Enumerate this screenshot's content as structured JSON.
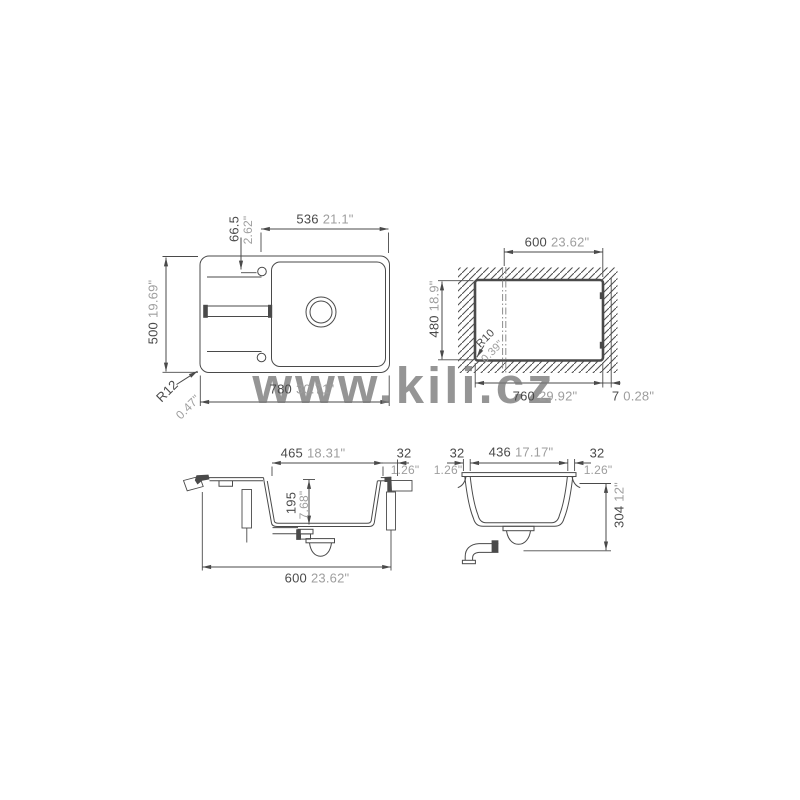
{
  "watermark": "www.kili.cz",
  "colors": {
    "line": "#4a4a4a",
    "metric_text": "#4a4a4a",
    "inch_text": "#9e9e9e",
    "watermark": "#787878"
  },
  "views": {
    "top": {
      "faucet_offset": {
        "mm": "536",
        "in": "21.1\""
      },
      "faucet_inset": {
        "mm": "66.5",
        "in": "2.62\""
      },
      "depth": {
        "mm": "500",
        "in": "19.69\""
      },
      "width": {
        "mm": "780",
        "in": "30.71\""
      },
      "corner_radius": {
        "mm": "R12",
        "in": "0.47\""
      }
    },
    "cutout": {
      "top_width": {
        "mm": "600",
        "in": "23.62\""
      },
      "depth": {
        "mm": "480",
        "in": "18.9\""
      },
      "corner_radius": {
        "mm": "R10",
        "in": "0.39\""
      },
      "width": {
        "mm": "760",
        "in": "29.92\""
      },
      "edge_gap": {
        "mm": "7",
        "in": "0.28\""
      }
    },
    "side_section": {
      "bowl_length": {
        "mm": "465",
        "in": "18.31\""
      },
      "rim": {
        "mm": "32",
        "in": "1.26\""
      },
      "bowl_depth": {
        "mm": "195",
        "in": "7.68\""
      },
      "cabinet_width": {
        "mm": "600",
        "in": "23.62\""
      }
    },
    "front_section": {
      "rim_left": {
        "mm": "32",
        "in": "1.26\""
      },
      "bowl_width": {
        "mm": "436",
        "in": "17.17\""
      },
      "rim_right": {
        "mm": "32",
        "in": "1.26\""
      },
      "total_depth": {
        "mm": "304",
        "in": "12\""
      }
    }
  }
}
